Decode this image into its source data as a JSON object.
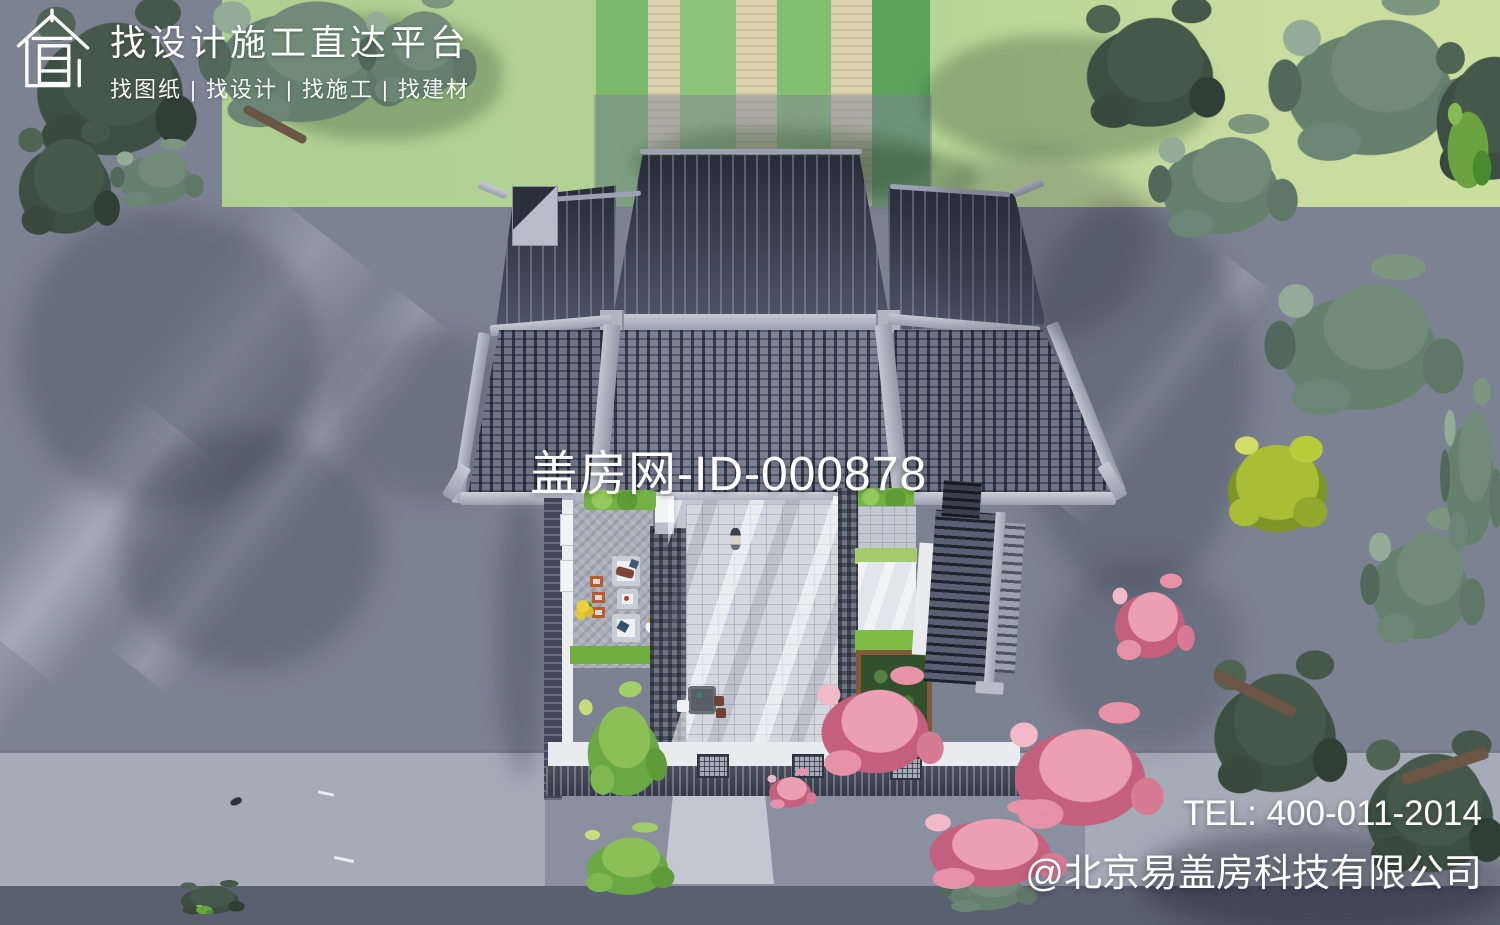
{
  "branding": {
    "logo_icon": "house-outline-logo",
    "title": "找设计施工直达平台",
    "subtitle": "找图纸 | 找设计 | 找施工 | 找建材"
  },
  "watermark": {
    "site_id": "盖房网-ID-000878"
  },
  "contact": {
    "tel": "TEL: 400-011-2014",
    "company": "@北京易盖房科技有限公司"
  },
  "scene": {
    "description": "Aerial top-down rendering of a Chinese courtyard house with gray tiled roofs, stone courtyard, pink blossom tree, lawn with stone paths, surrounding roads and trees",
    "colors": {
      "road": "#7b8292",
      "roadLight": "#a6abb8",
      "roadDark": "#596070",
      "lawn": "#aed093",
      "lawnYellow": "#c6db9e",
      "pathBeige": "#ddd2b0",
      "roofDark": "#2d3240",
      "roofMid": "#6f7588",
      "ridge": "#b4b8c4",
      "wallWhite": "#ecedef",
      "wallDark": "#42465 4",
      "court": "#d4d7de",
      "grass": "#7fbc45",
      "bedGreen": "#32502c",
      "bedBrown": "#82583a",
      "blossom": "#e592a9",
      "treeSage": "#718b78",
      "treeDark": "#45584a",
      "treeYellow": "#a9bd35",
      "bamboo": "#7fb750",
      "chairOrange": "#b85c2c",
      "flowerYellow": "#e9c832"
    }
  }
}
